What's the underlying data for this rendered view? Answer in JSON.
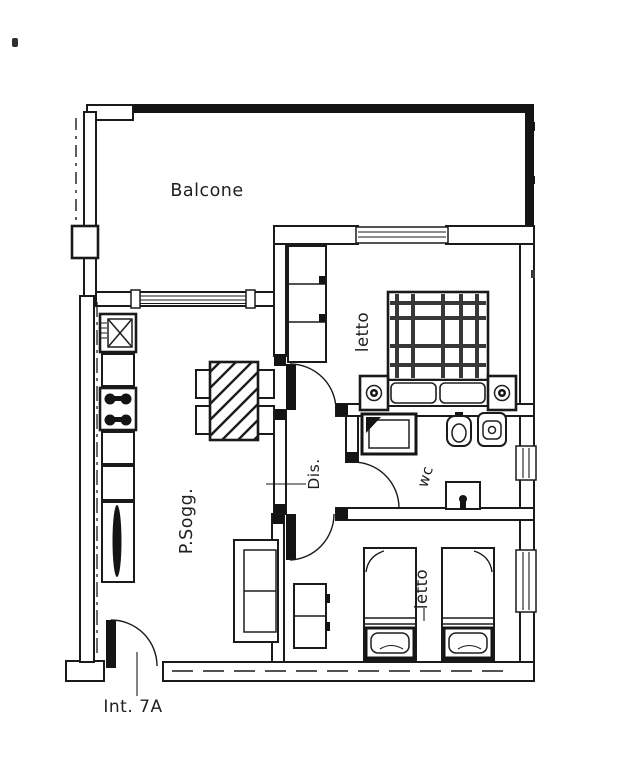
{
  "plan": {
    "rooms": [
      {
        "id": "balcone",
        "label": "Balcone"
      },
      {
        "id": "camera-matrimoniale",
        "label": "letto"
      },
      {
        "id": "soggiorno-pranzo",
        "label": "P.Sogg."
      },
      {
        "id": "disimpegno",
        "label": "Dis."
      },
      {
        "id": "bagno",
        "label": "wc"
      },
      {
        "id": "camera-doppia",
        "label": "letto"
      }
    ],
    "entrance": {
      "label": "Int. 7A"
    }
  },
  "colors": {
    "ink": "#1a1a1a",
    "paper": "#ffffff",
    "text": "#1f1f1f"
  }
}
